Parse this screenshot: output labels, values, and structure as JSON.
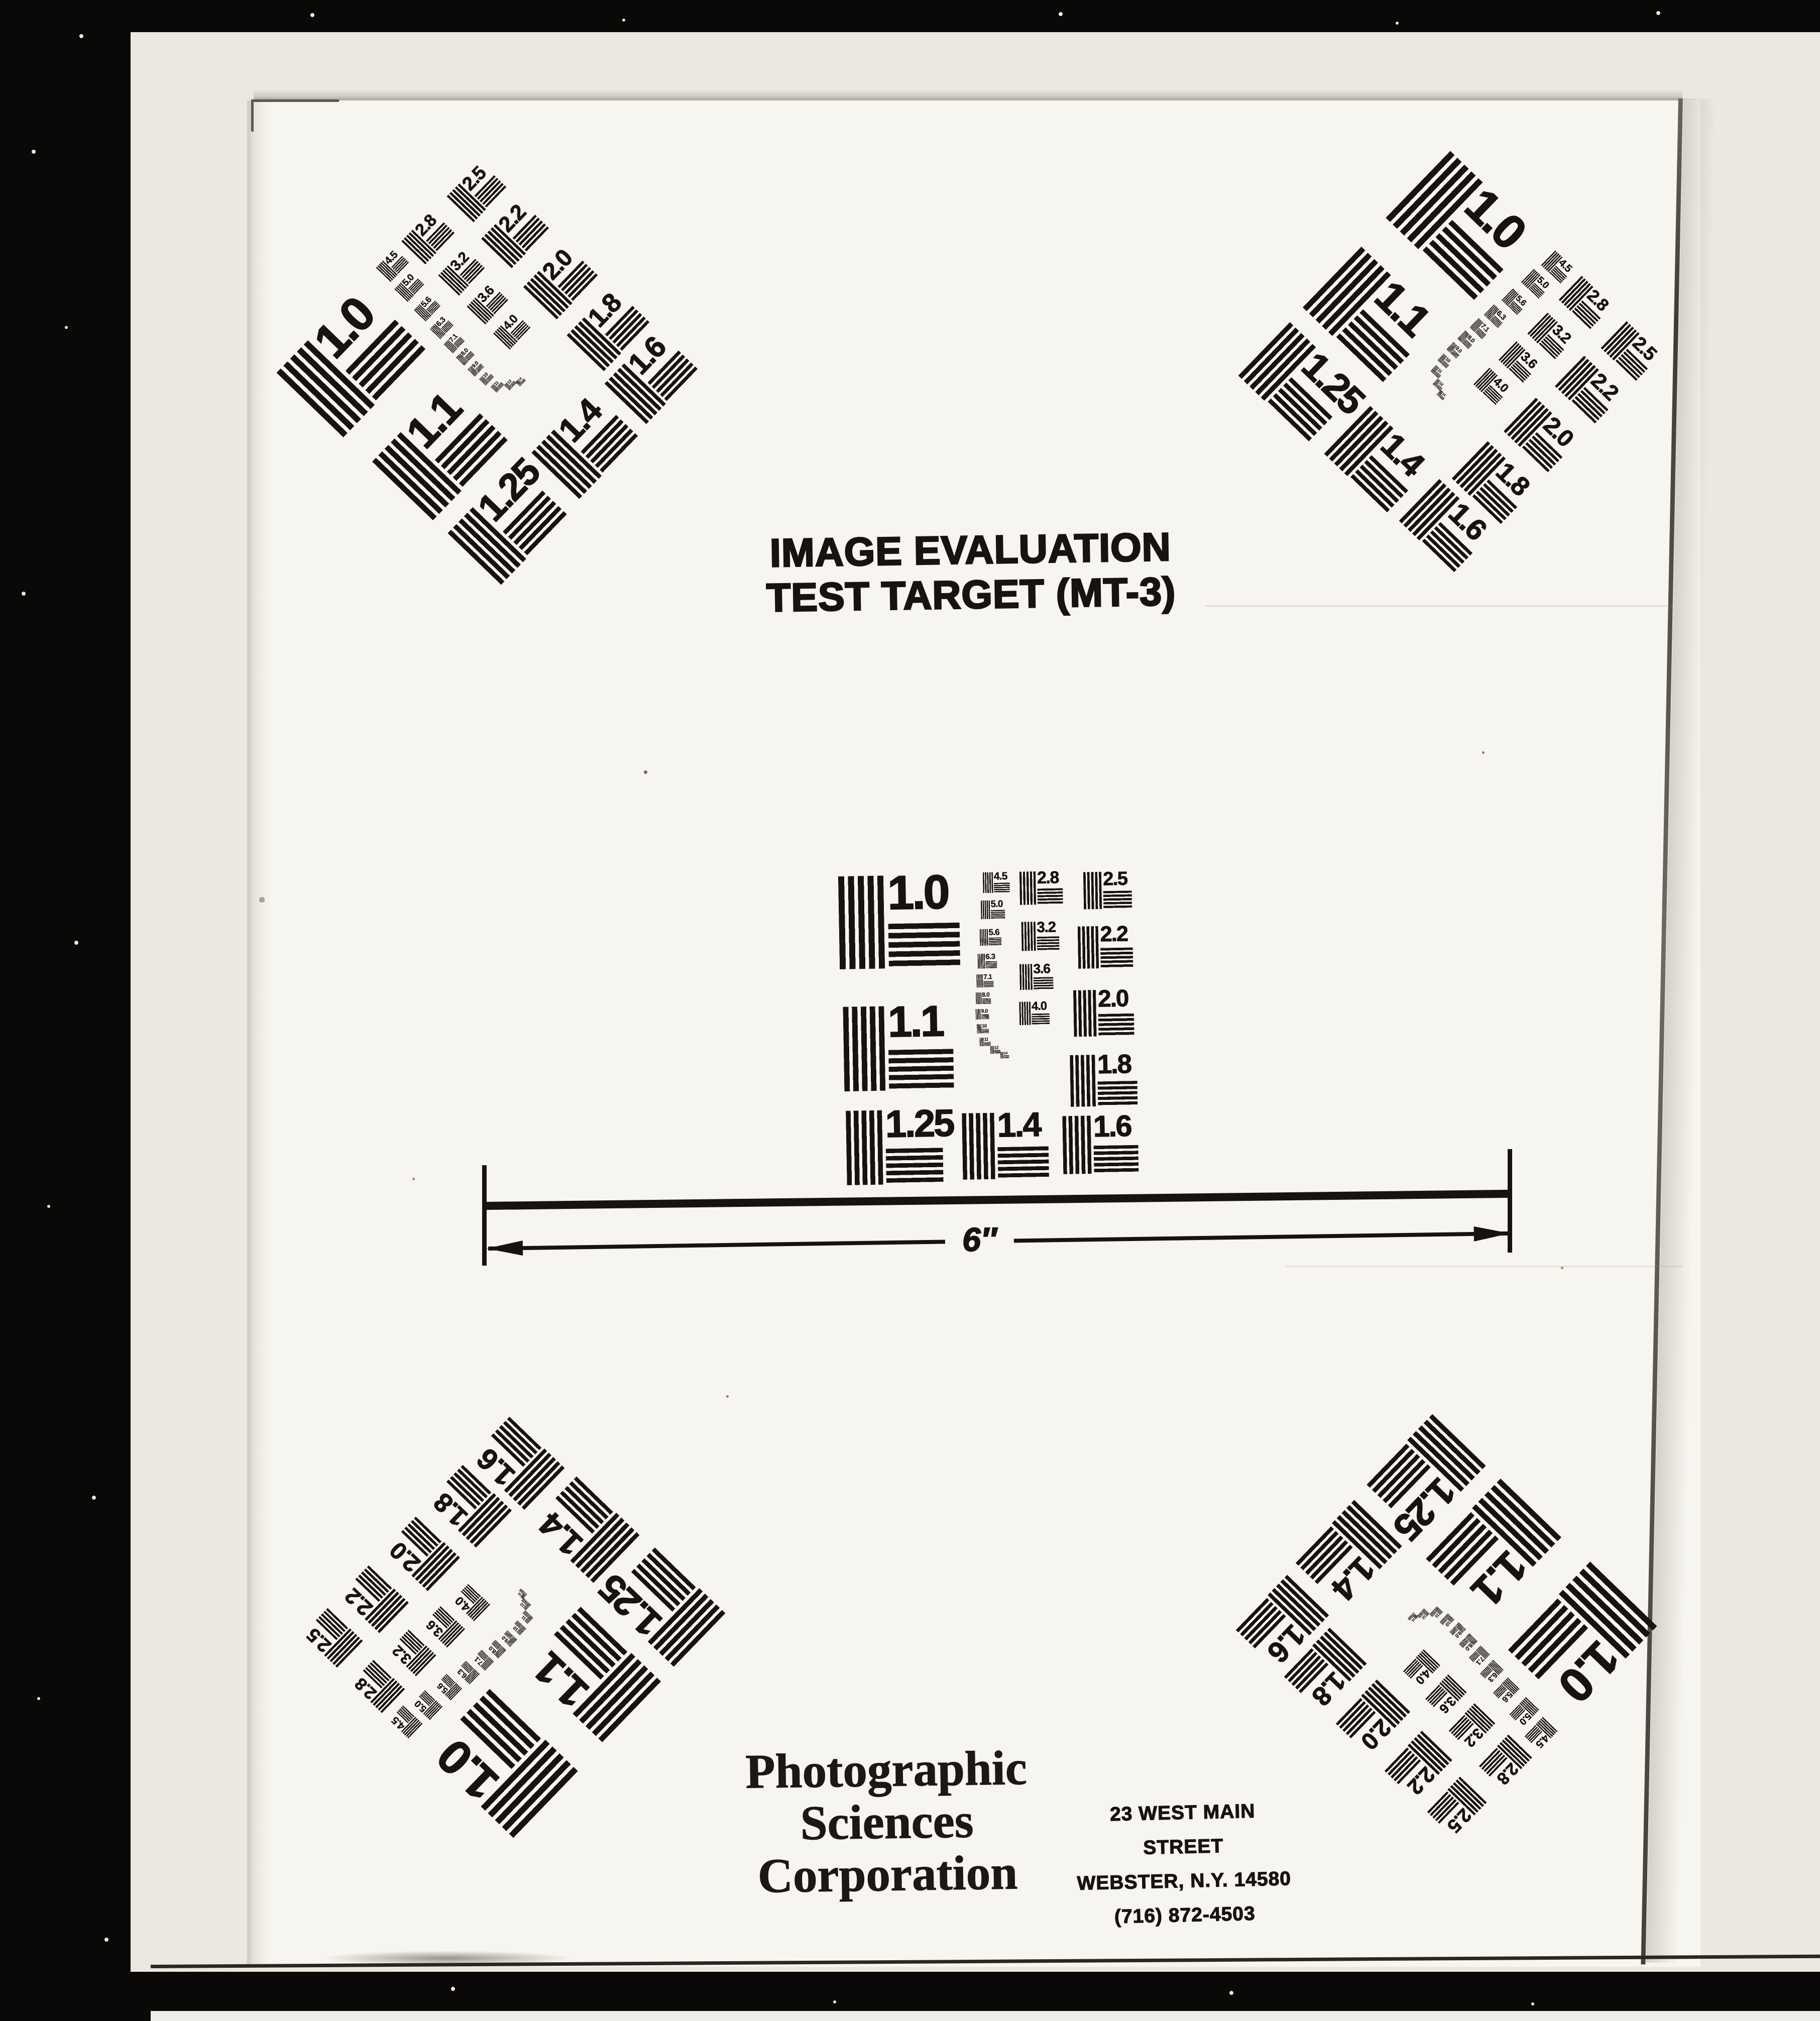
{
  "scan": {
    "title_line1": "IMAGE EVALUATION",
    "title_line2": "TEST TARGET (MT-3)",
    "measure_label": "6″",
    "company_line1": "Photographic",
    "company_line2": "Sciences",
    "company_line3": "Corporation",
    "address_line1": "23 WEST MAIN STREET",
    "address_line2": "WEBSTER, N.Y. 14580",
    "address_line3": "(716) 872-4503"
  },
  "colors": {
    "ink": "#17140f",
    "paper": "#f7f5ef",
    "backing": "#ebe8e0",
    "scanner_black": "#0a0908"
  },
  "target_patches": [
    {
      "label": "1.0",
      "x": 1.5,
      "y": 1.2
    },
    {
      "label": "1.1",
      "x": 2.4,
      "y": 44.5
    },
    {
      "label": "1.25",
      "x": 2.7,
      "y": 79.0
    },
    {
      "label": "1.4",
      "x": 41.9,
      "y": 80.5
    },
    {
      "label": "1.6",
      "x": 75.8,
      "y": 82.0
    },
    {
      "label": "1.8",
      "x": 78.6,
      "y": 61.8
    },
    {
      "label": "2.0",
      "x": 80.2,
      "y": 40.3
    },
    {
      "label": "2.2",
      "x": 82.0,
      "y": 19.2
    },
    {
      "label": "2.5",
      "x": 84.2,
      "y": 1.2
    },
    {
      "label": "2.8",
      "x": 62.7,
      "y": 0.7
    },
    {
      "label": "3.2",
      "x": 63.0,
      "y": 17.3
    },
    {
      "label": "3.6",
      "x": 62.2,
      "y": 31.3
    },
    {
      "label": "4.0",
      "x": 61.9,
      "y": 43.8
    },
    {
      "label": "4.5",
      "x": 50.3,
      "y": 0.7
    },
    {
      "label": "5.0",
      "x": 49.5,
      "y": 10.0
    },
    {
      "label": "5.6",
      "x": 49.0,
      "y": 19.5
    },
    {
      "label": "6.3",
      "x": 48.1,
      "y": 27.7
    },
    {
      "label": "7.1",
      "x": 47.6,
      "y": 34.5
    },
    {
      "label": "8.0",
      "x": 47.3,
      "y": 40.5
    },
    {
      "label": "9.0",
      "x": 47.1,
      "y": 46.0
    },
    {
      "label": "10",
      "x": 47.5,
      "y": 51.0
    },
    {
      "label": "11",
      "x": 48.3,
      "y": 55.5
    },
    {
      "label": "12",
      "x": 51.8,
      "y": 58.3
    },
    {
      "label": "14",
      "x": 55.2,
      "y": 60.3
    }
  ]
}
